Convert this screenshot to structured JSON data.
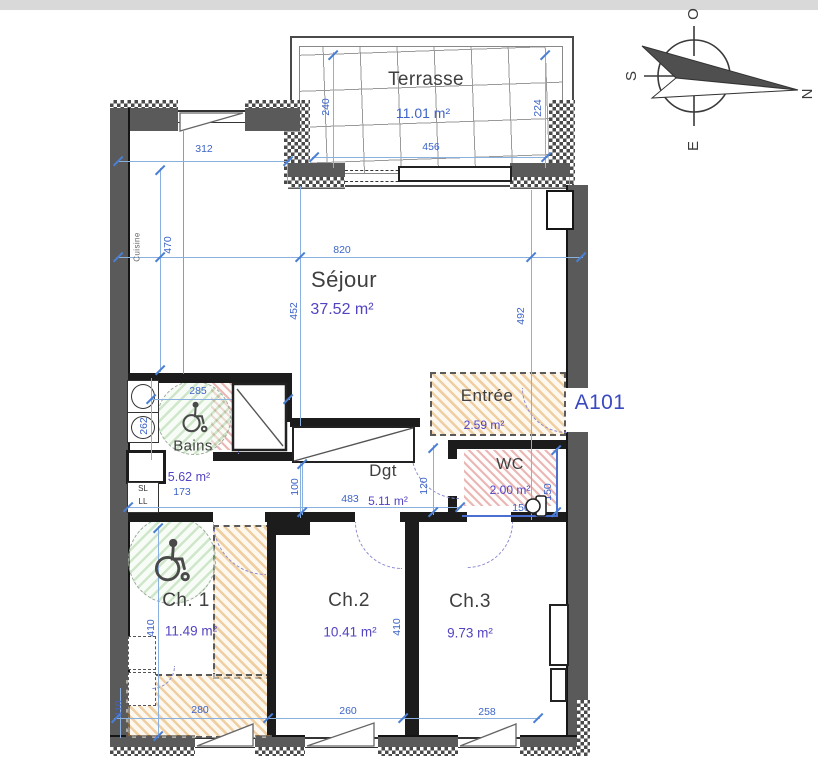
{
  "title": {
    "apartment": "A101"
  },
  "compass": {
    "west": "O",
    "south": "S",
    "east": "E",
    "north": "N"
  },
  "rooms": {
    "terrasse": {
      "name": "Terrasse",
      "area": "11.01 m²"
    },
    "sejour": {
      "name": "Séjour",
      "area": "37.52 m²"
    },
    "cuisine": {
      "name": "Cuisine"
    },
    "bains": {
      "name": "Bains",
      "area": "5.62 m²"
    },
    "entree": {
      "name": "Entrée",
      "area": "2.59 m²"
    },
    "wc": {
      "name": "WC",
      "area": "2.00 m²"
    },
    "dgt": {
      "name": "Dgt",
      "area": "5.11 m²"
    },
    "ch1": {
      "name": "Ch. 1",
      "area": "11.49 m²"
    },
    "ch2": {
      "name": "Ch.2",
      "area": "10.41 m²"
    },
    "ch3": {
      "name": "Ch.3",
      "area": "9.73 m²"
    }
  },
  "appliances": {
    "sl": "SL",
    "ll": "LL"
  },
  "dims": {
    "window_sejour": "312",
    "kitchen_depth": "470",
    "sejour_width": "820",
    "sejour_height_left": "452",
    "sejour_height_right": "492",
    "terrasse_left": "240",
    "terrasse_right": "224",
    "terrasse_width": "456",
    "bains_width": "285",
    "bains_depth": "262",
    "bains_alcove": "173",
    "dgt_left": "100",
    "dgt_length": "483",
    "dgt_right": "120",
    "wc_width": "150",
    "wc_depth": "150",
    "ch1_height": "410",
    "ch2_height": "410",
    "bottom_left_height": "410",
    "ch1_width": "280",
    "ch2_width": "260",
    "ch3_width": "258"
  },
  "colors": {
    "dimension_blue": "#3E64C8",
    "area_purple": "#5243C2",
    "label_gray": "#3F3F3F",
    "unit_blue": "#3A49C0",
    "wall_gray": "#5A5A5A",
    "hatch_orange": "#E2A656",
    "hatch_red": "#D66E6E",
    "hatch_green": "#94C88A",
    "door_arc_purple": "#8A8AD2"
  }
}
